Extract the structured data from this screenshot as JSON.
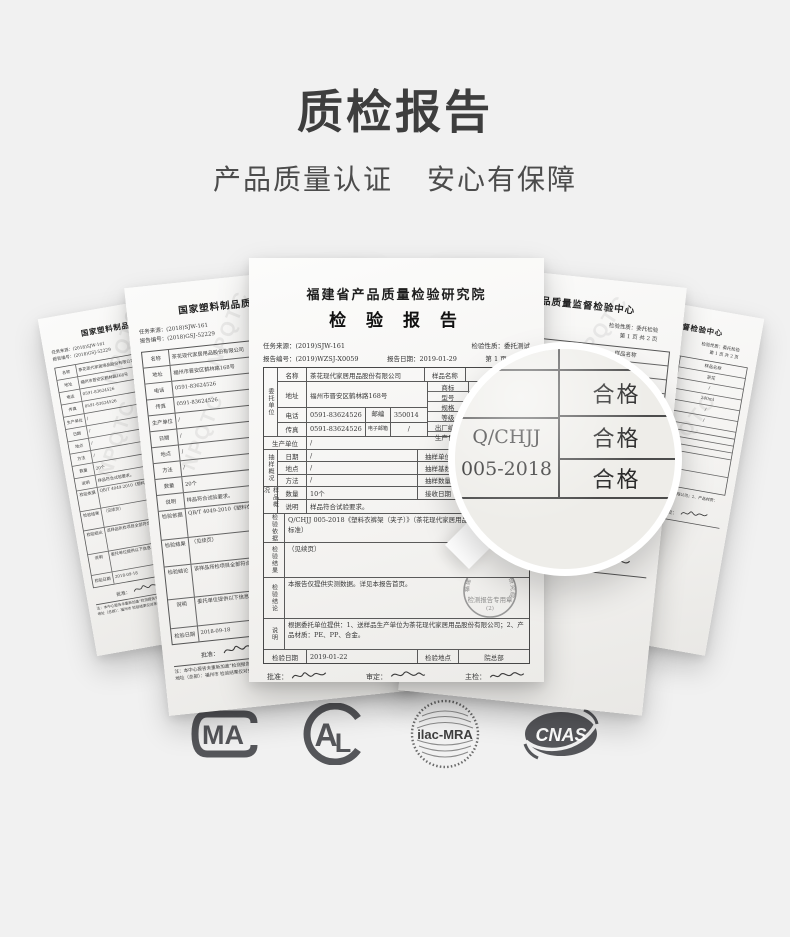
{
  "colors": {
    "background": "#f1f1f1",
    "title_text": "#3e3e3e",
    "logo_gray": "#55565a",
    "paper_line": "#555555"
  },
  "header": {
    "title": "质检报告",
    "subtitle_left": "产品质量认证",
    "subtitle_right": "安心有保障"
  },
  "watermark": "NPQTC",
  "magnifier": {
    "standard_line1": "Q/CHJJ",
    "standard_line2": "005-2018",
    "result1": "合格",
    "result2": "合格",
    "result3": "合格"
  },
  "center_doc": {
    "institute": "福建省产品质量检验研究院",
    "title": "检 验 报 告",
    "meta1_left": "任务来源：(2019)SJW-161",
    "meta1_right": "检验性质：委托测试",
    "meta2_left": "报告编号：(2019)WZSJ-X0059",
    "meta2_mid": "报告日期：2019-01-29",
    "meta2_right": "第 1 页  共 2 页",
    "grp_client": "委托单位",
    "grp_sampling": "抽样概况",
    "grp_sample": "样品概况",
    "grp_basis": "检验依据",
    "grp_result": "检验结果",
    "grp_conclusion": "检验结论",
    "grp_note": "说明",
    "lbl_name": "名称",
    "val_name": "茶花现代家居用品股份有限公司",
    "lbl_sample_name": "样品名称",
    "val_sample_name": "晾衣架",
    "lbl_addr": "地址",
    "val_addr": "福州市晋安区鹤林路168号",
    "lbl_brand": "商标",
    "val_brand": "茶花",
    "lbl_model": "型号",
    "val_model": "/",
    "lbl_spec": "规格",
    "val_spec": "",
    "lbl_grade": "等级",
    "val_grade": "",
    "lbl_factory_no": "出厂编号",
    "val_factory_no": "",
    "lbl_prod_date": "生产日期",
    "val_prod_date": "",
    "lbl_phone": "电话",
    "val_phone": "0591-83624526",
    "lbl_zip": "邮编",
    "val_zip": "350014",
    "lbl_fax": "传真",
    "val_fax": "0591-83624526",
    "lbl_email": "电子邮箱",
    "val_email": "/",
    "lbl_producer": "生产单位",
    "val_producer": "/",
    "lbl_s_date": "日期",
    "val_s_date": "/",
    "lbl_s_unit": "抽样单位",
    "val_s_unit": "/",
    "lbl_s_place": "地点",
    "val_s_place": "/",
    "lbl_s_base": "抽样基数",
    "val_s_base": "/",
    "lbl_s_method": "方法",
    "val_s_method": "/",
    "lbl_s_qty": "抽样数量",
    "val_s_qty": "/",
    "lbl_qty": "数量",
    "val_qty": "10个",
    "lbl_recv": "接收日期",
    "val_recv": "2019-01-22",
    "lbl_desc": "说明",
    "val_desc": "样品符合试验要求。",
    "val_basis": "Q/CHJJ 005-2018《塑料衣裤架（夹子）》（茶花现代家居用品股份有限公司企业标准）",
    "val_result": "（见续页）",
    "val_conclusion": "本报告仅提供实测数据。详见本报告首页。",
    "val_note": "根据委托单位提供：1、送样品生产单位为茶花现代家居用品股份有限公司；2、产品材质：PE、PP、合金。",
    "lbl_insp_date": "检验日期",
    "val_insp_date": "2019-01-22",
    "lbl_insp_place": "检验地点",
    "val_insp_place": "院总部",
    "lbl_approve": "批准：",
    "lbl_review": "审定：",
    "lbl_chief": "主检：",
    "stamp_ring": "福建省产品质量检验研究院",
    "stamp_label": "检测报告专用章",
    "stamp_sub": "(2)",
    "footnote1": "注：复制报告未重新加盖“检测报告专用章”无效！",
    "footnote2": "检验结果仅对来样负责，未经检验机构同意，委托人不得擅自使用检验结果进行不当宣传！"
  },
  "left_doc": {
    "institute": "国家塑料制品质量监督检验中心",
    "meta1": "任务来源：(2018)SJW-161",
    "meta2": "报告编号：(2018)GSJ-52229",
    "rows": [
      {
        "l": "名称",
        "v": "茶花现代家居用品股份有限公司"
      },
      {
        "l": "地址",
        "v": "福州市晋安区鹤林路168号"
      },
      {
        "l": "电话",
        "v": "0591-83624526"
      },
      {
        "l": "传真",
        "v": "0591-83624526"
      },
      {
        "l": "生产单位",
        "v": "/"
      },
      {
        "l": "日期",
        "v": "/"
      },
      {
        "l": "地点",
        "v": "/"
      },
      {
        "l": "方法",
        "v": "/"
      },
      {
        "l": "数量",
        "v": "20个"
      },
      {
        "l": "说明",
        "v": "样品符合试验要求。"
      }
    ],
    "lbl_basis": "检验依据",
    "val_basis": "QB/T 4049-2010《塑料衣架》 GB4806.7-2016《食品安全国家标准》",
    "lbl_result": "检验结果",
    "val_result": "（见续页）",
    "lbl_conclusion": "检验结论",
    "val_conclusion": "该样品所检项目全部符合标准要求。",
    "lbl_note": "说明",
    "val_note": "委托单位提供以下信息，未经检验机构同意，不得擅自使用。",
    "lbl_date": "检验日期",
    "val_date": "2018-09-18",
    "lbl_approve": "批准：",
    "foot1": "注：本中心报告未重新加盖“检测报告专用章”无效！",
    "foot2": "地址（总部）：福州市  检验结果仅对来样负责。"
  },
  "right_doc": {
    "institute": "国家塑料制品质量监督检验中心",
    "meta1": "检验性质：委托检验",
    "meta2": "第 1 页  共 2 页",
    "col_header": "样品名称",
    "values": [
      "茶花",
      "/",
      "240ml",
      "/",
      "/"
    ],
    "note": "1、送样品生产单位为茶花现代家居用品股份有限公司；2、产品材质：PE。",
    "chief_label": "主检：",
    "foot": "Fuzhou, P. R. China"
  },
  "logos": {
    "cma_text": "MA",
    "cal_a": "A",
    "cal_l": "L",
    "ilac_text": "ilac-MRA",
    "cnas_text": "CNAS"
  }
}
